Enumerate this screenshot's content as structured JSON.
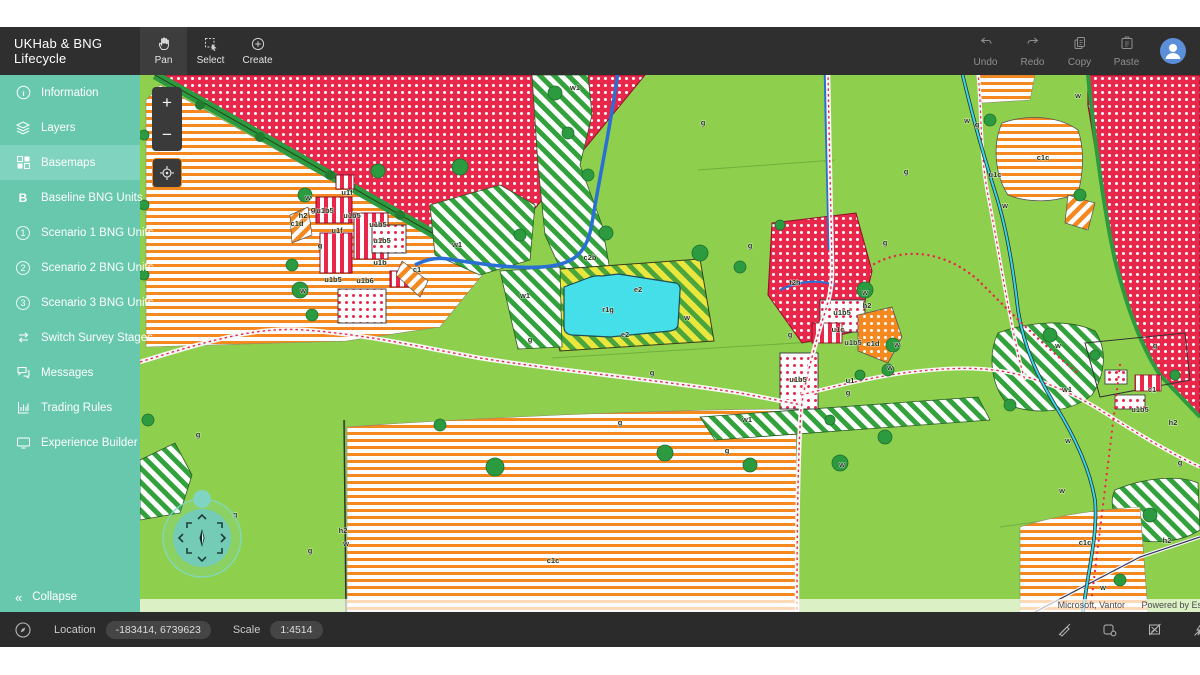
{
  "app": {
    "title": "UKHab & BNG Lifecycle"
  },
  "topbar": {
    "tools": [
      {
        "label": "Pan",
        "active": true
      },
      {
        "label": "Select",
        "active": false
      },
      {
        "label": "Create",
        "active": false
      }
    ],
    "actions": [
      {
        "label": "Undo"
      },
      {
        "label": "Redo"
      },
      {
        "label": "Copy"
      },
      {
        "label": "Paste"
      }
    ]
  },
  "sidebar": {
    "items": [
      {
        "label": "Information",
        "icon": "info-icon",
        "active": false
      },
      {
        "label": "Layers",
        "icon": "layers-icon",
        "active": false
      },
      {
        "label": "Basemaps",
        "icon": "basemaps-icon",
        "active": true
      },
      {
        "label": "Baseline BNG Units",
        "icon": "baseline-bng-icon",
        "active": false
      },
      {
        "label": "Scenario 1 BNG Units",
        "icon": "scenario-1-icon",
        "active": false
      },
      {
        "label": "Scenario 2 BNG Units",
        "icon": "scenario-2-icon",
        "active": false
      },
      {
        "label": "Scenario 3 BNG Units",
        "icon": "scenario-3-icon",
        "active": false
      },
      {
        "label": "Switch Survey Stages",
        "icon": "switch-icon",
        "active": false
      },
      {
        "label": "Messages",
        "icon": "messages-icon",
        "active": false
      },
      {
        "label": "Trading Rules",
        "icon": "trading-rules-icon",
        "active": false
      },
      {
        "label": "Experience Builder",
        "icon": "experience-builder-icon",
        "active": false
      }
    ],
    "scenario_numbers": [
      "1",
      "2",
      "3"
    ],
    "collapse_label": "Collapse",
    "collapse_glyph": "«"
  },
  "map_controls": {
    "zoom_in": "+",
    "zoom_out": "−"
  },
  "map": {
    "attribution": "Microsoft, Vantor",
    "powered_by": "Powered by Esri",
    "labels": [
      {
        "t": "g",
        "x": 563,
        "y": 50
      },
      {
        "t": "g",
        "x": 610,
        "y": 173
      },
      {
        "t": "g",
        "x": 512,
        "y": 300
      },
      {
        "t": "g",
        "x": 173,
        "y": 137
      },
      {
        "t": "g",
        "x": 180,
        "y": 173
      },
      {
        "t": "g",
        "x": 390,
        "y": 267
      },
      {
        "t": "g",
        "x": 650,
        "y": 262
      },
      {
        "t": "g",
        "x": 708,
        "y": 320
      },
      {
        "t": "g",
        "x": 745,
        "y": 170
      },
      {
        "t": "g",
        "x": 837,
        "y": 52
      },
      {
        "t": "g",
        "x": 766,
        "y": 99
      },
      {
        "t": "g",
        "x": 1040,
        "y": 390
      },
      {
        "t": "g",
        "x": 1015,
        "y": 273
      },
      {
        "t": "g",
        "x": 170,
        "y": 478
      },
      {
        "t": "g",
        "x": 58,
        "y": 362
      },
      {
        "t": "g",
        "x": 587,
        "y": 378
      },
      {
        "t": "g",
        "x": 480,
        "y": 350
      },
      {
        "t": "g",
        "x": 95,
        "y": 442
      },
      {
        "t": "w",
        "x": 725,
        "y": 220
      },
      {
        "t": "w",
        "x": 757,
        "y": 272
      },
      {
        "t": "w",
        "x": 750,
        "y": 295
      },
      {
        "t": "w",
        "x": 206,
        "y": 471
      },
      {
        "t": "w",
        "x": 918,
        "y": 273
      },
      {
        "t": "w",
        "x": 928,
        "y": 368
      },
      {
        "t": "w",
        "x": 922,
        "y": 418
      },
      {
        "t": "w",
        "x": 963,
        "y": 515
      },
      {
        "t": "w",
        "x": 168,
        "y": 125
      },
      {
        "t": "w",
        "x": 163,
        "y": 218
      },
      {
        "t": "w",
        "x": 547,
        "y": 245
      },
      {
        "t": "w",
        "x": 827,
        "y": 48
      },
      {
        "t": "w",
        "x": 938,
        "y": 23
      },
      {
        "t": "w",
        "x": 865,
        "y": 133
      },
      {
        "t": "w",
        "x": 702,
        "y": 392
      },
      {
        "t": "w1",
        "x": 435,
        "y": 15
      },
      {
        "t": "w1",
        "x": 317,
        "y": 172
      },
      {
        "t": "w1",
        "x": 385,
        "y": 223
      },
      {
        "t": "w1",
        "x": 927,
        "y": 317
      },
      {
        "t": "w1",
        "x": 607,
        "y": 347
      },
      {
        "t": "r1g",
        "x": 468,
        "y": 237
      },
      {
        "t": "e2",
        "x": 498,
        "y": 217
      },
      {
        "t": "e2",
        "x": 485,
        "y": 262
      },
      {
        "t": "c1c",
        "x": 413,
        "y": 488
      },
      {
        "t": "c1c",
        "x": 903,
        "y": 85
      },
      {
        "t": "c1c",
        "x": 945,
        "y": 470
      },
      {
        "t": "c1d",
        "x": 733,
        "y": 271
      },
      {
        "t": "c1d",
        "x": 157,
        "y": 151
      },
      {
        "t": "u1b5",
        "x": 185,
        "y": 138
      },
      {
        "t": "u1b5",
        "x": 212,
        "y": 143
      },
      {
        "t": "u1b5",
        "x": 238,
        "y": 152
      },
      {
        "t": "u1b5",
        "x": 242,
        "y": 168
      },
      {
        "t": "u1b5",
        "x": 193,
        "y": 207
      },
      {
        "t": "u1b5",
        "x": 658,
        "y": 307
      },
      {
        "t": "u1b5",
        "x": 702,
        "y": 240
      },
      {
        "t": "u1b5",
        "x": 713,
        "y": 270
      },
      {
        "t": "u1b5",
        "x": 1000,
        "y": 337
      },
      {
        "t": "u1b6",
        "x": 225,
        "y": 208
      },
      {
        "t": "u1b",
        "x": 240,
        "y": 190
      },
      {
        "t": "u1c",
        "x": 698,
        "y": 257
      },
      {
        "t": "u1c",
        "x": 855,
        "y": 102
      },
      {
        "t": "u1f",
        "x": 207,
        "y": 120
      },
      {
        "t": "u1f",
        "x": 197,
        "y": 158
      },
      {
        "t": "u1",
        "x": 710,
        "y": 308
      },
      {
        "t": "c1",
        "x": 277,
        "y": 197
      },
      {
        "t": "c1",
        "x": 1012,
        "y": 317
      },
      {
        "t": "h2",
        "x": 163,
        "y": 143
      },
      {
        "t": "h2",
        "x": 203,
        "y": 458
      },
      {
        "t": "h2",
        "x": 1027,
        "y": 468
      },
      {
        "t": "h2",
        "x": 727,
        "y": 233
      },
      {
        "t": "h2",
        "x": 1033,
        "y": 350
      },
      {
        "t": "t2h",
        "x": 655,
        "y": 210
      },
      {
        "t": "c2b",
        "x": 450,
        "y": 185
      }
    ]
  },
  "statusbar": {
    "location_label": "Location",
    "location_value": "-183414, 6739623",
    "scale_label": "Scale",
    "scale_value": "1:4514"
  },
  "colors": {
    "sidebar": "#68c8ae",
    "sidebar_active": "#80d3bf",
    "topbar": "#2f2f2f",
    "statusbar": "#2b2b2b",
    "field_green": "#8ed04d",
    "tree_green": "#2c9a3f",
    "crimson": "#e8274b",
    "orange": "#f5891f",
    "pond_cyan": "#44dfe9",
    "river_blue": "#2a6fd4",
    "stream_cyan": "#35d8e8",
    "hatch_yellow": "#e9e73e"
  }
}
